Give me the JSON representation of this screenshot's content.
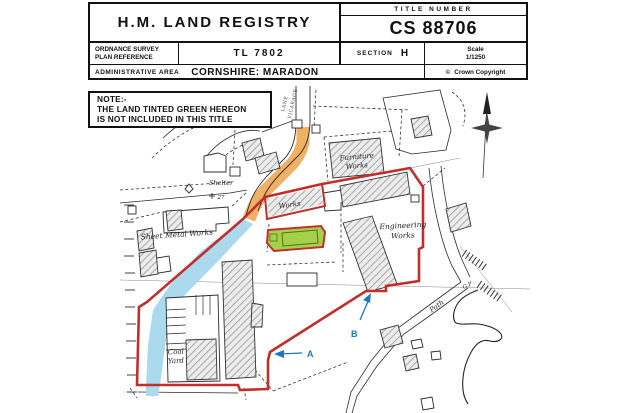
{
  "header": {
    "registry_title": "H.M. LAND REGISTRY",
    "title_number_label": "TITLE NUMBER",
    "title_number": "CS 88706",
    "os_ref_label_line1": "ORDNANCE SURVEY",
    "os_ref_label_line2": "PLAN REFERENCE",
    "os_ref_value": "TL 7802",
    "section_label": "SECTION",
    "section_value": "H",
    "scale_label": "Scale",
    "scale_value": "1/1250",
    "admin_area_label": "ADMINISTRATIVE AREA",
    "admin_area_value": "CORNSHIRE: MARADON",
    "copyright_symbol": "©",
    "copyright_text": "Crown Copyright"
  },
  "note": {
    "line1": "NOTE:-",
    "line2": "THE LAND TINTED GREEN HEREON",
    "line3": "IS NOT INCLUDED IN THIS TITLE"
  },
  "map": {
    "labels": {
      "vicarage_lane_word1": "VICARAGE",
      "vicarage_lane_word2": "LANE",
      "furniture_works_line1": "Furniture",
      "furniture_works_line2": "Works",
      "works": "Works",
      "engineering_works_line1": "Engineering",
      "engineering_works_line2": "Works",
      "sheet_metal_works": "Sheet Metal Works",
      "shelter": "Shelter",
      "benchmark_value": "27",
      "coal_yard_line1": "Coal",
      "coal_yard_line2": "Yard",
      "path": "Path",
      "guide_post": "G.P",
      "marker_a": "A",
      "marker_b": "B"
    },
    "colors": {
      "boundary_red": "#c12f2c",
      "lane_orange": "#f0b065",
      "water_blue": "#abd9ee",
      "plot_green": "#a6cf4a",
      "marker_blue": "#1a78c2"
    }
  }
}
